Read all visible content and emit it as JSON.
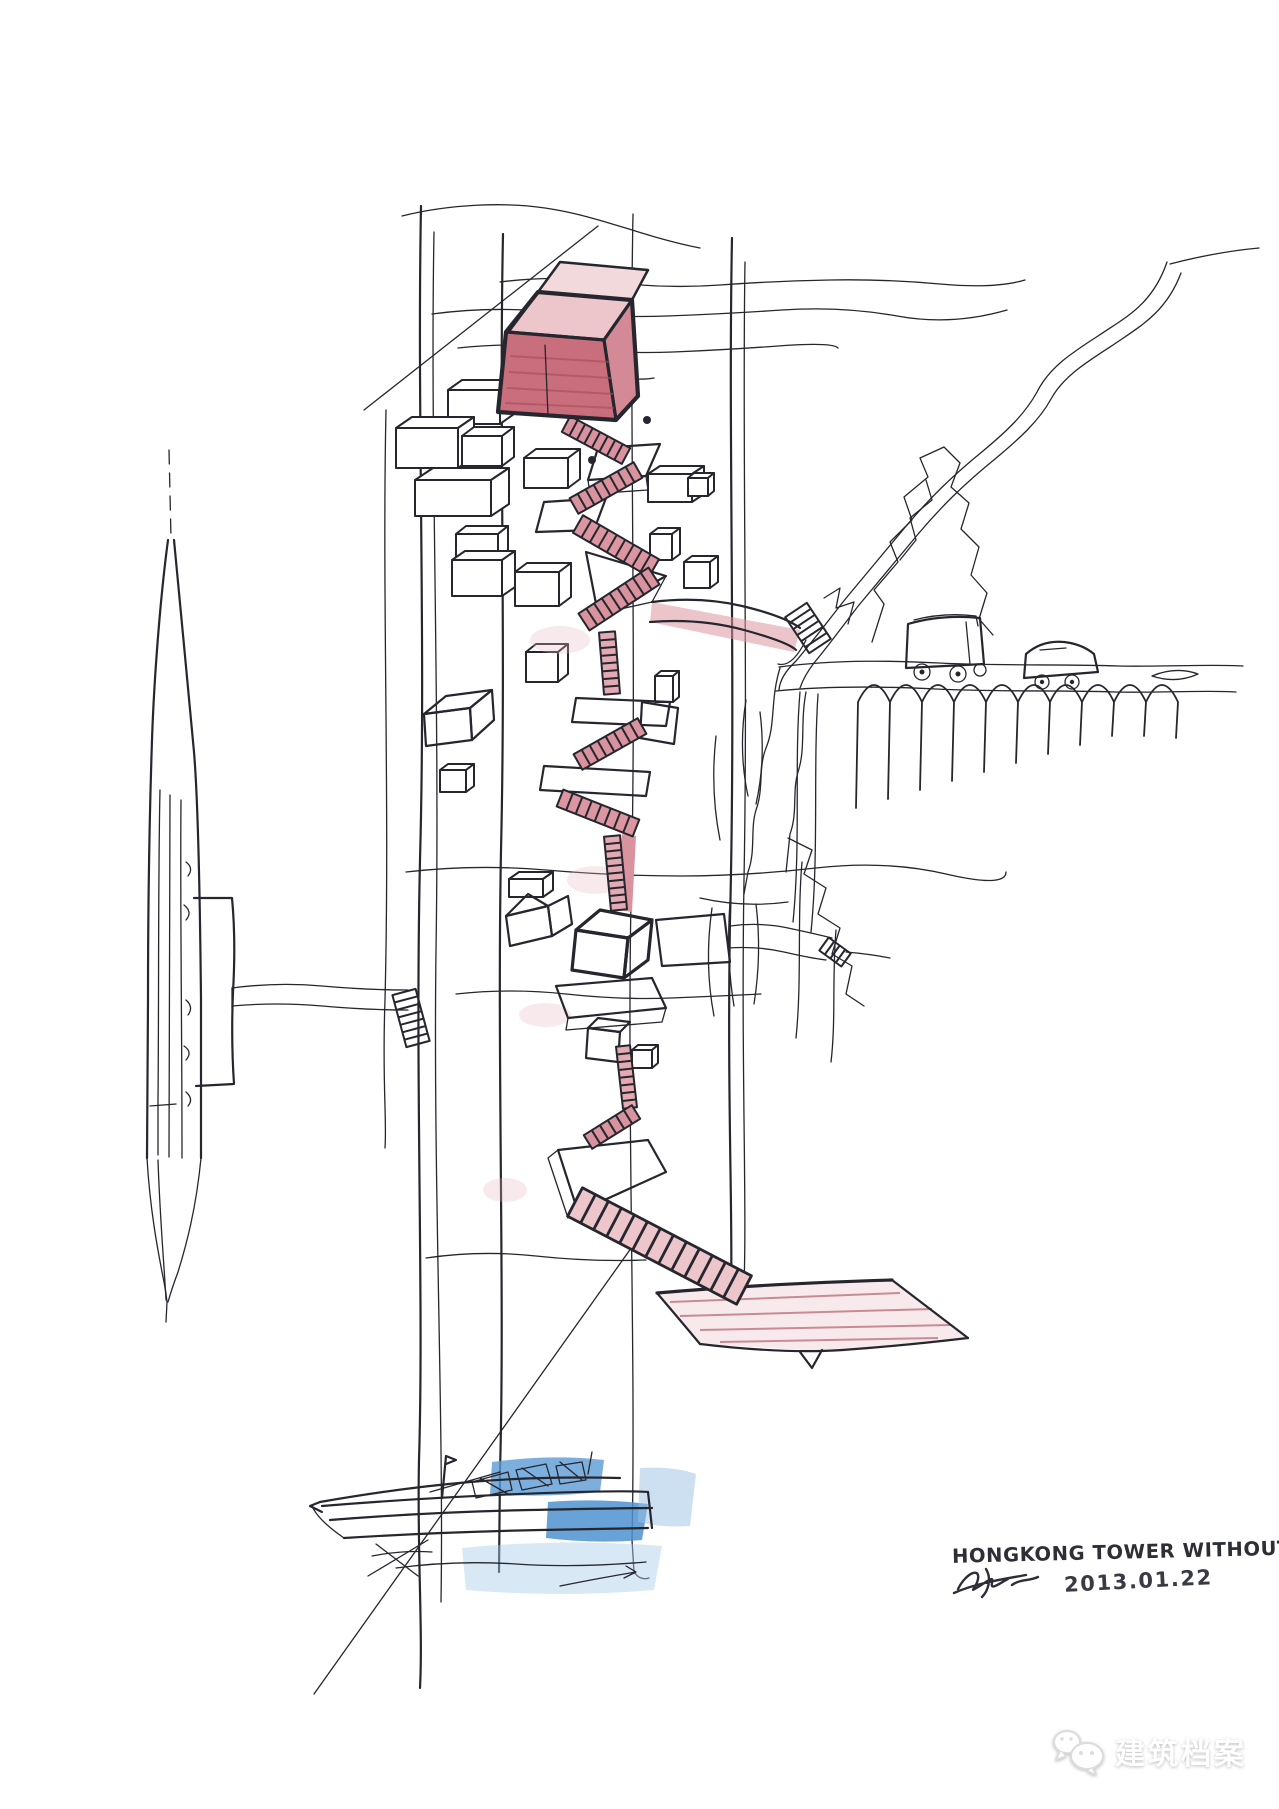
{
  "artwork": {
    "title": "HONGKONG TOWER WITHOUT LIFT",
    "signature_date": "2013.01.22"
  },
  "watermark": {
    "brand": "建筑档案",
    "icon": "wechat-logo-icon"
  },
  "palette": {
    "ink": "#26262e",
    "pink_wash": "#ecc6cb",
    "pink_mid": "#d9939e",
    "pink_deep": "#c96e7d",
    "red_front": "#c25b6b",
    "water_blue": "#4e92d0",
    "water_blue_light": "#abcbe9",
    "paper": "#ffffff"
  },
  "scene_elements": [
    "tower-shaft",
    "sky-red-box",
    "zigzag-stair",
    "stacked-houses",
    "left-spire-tower",
    "jetty-bridge",
    "hillside-road",
    "viaduct-arches",
    "bus-sketch",
    "car-sketch",
    "cliff-rocks",
    "ground-platform",
    "harbor-boat",
    "water-wash"
  ]
}
